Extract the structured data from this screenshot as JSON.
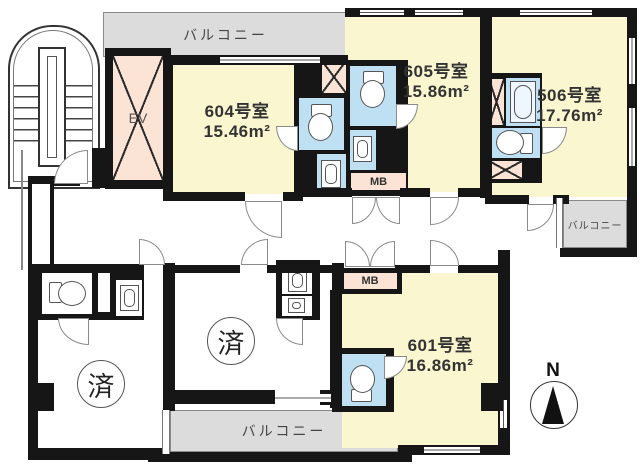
{
  "colors": {
    "room": "#faf6cf",
    "wet_area": "#bfdff2",
    "shaft": "#fbe3d6",
    "balcony": "#dcdcdc",
    "wall": "#161616"
  },
  "units": [
    {
      "number": "604号室",
      "area": "15.46m²"
    },
    {
      "number": "605号室",
      "area": "15.86m²"
    },
    {
      "number": "506号室",
      "area": "17.76m²"
    },
    {
      "number": "601号室",
      "area": "16.86m²"
    }
  ],
  "labels": {
    "balcony_top": "バルコニー",
    "balcony_right": "バルコニー",
    "balcony_bottom": "バルコニー",
    "elevator": "EV",
    "meter_box_upper": "MB",
    "meter_box_lower": "MB",
    "sold_left": "済",
    "sold_center": "済",
    "compass_north": "N"
  }
}
